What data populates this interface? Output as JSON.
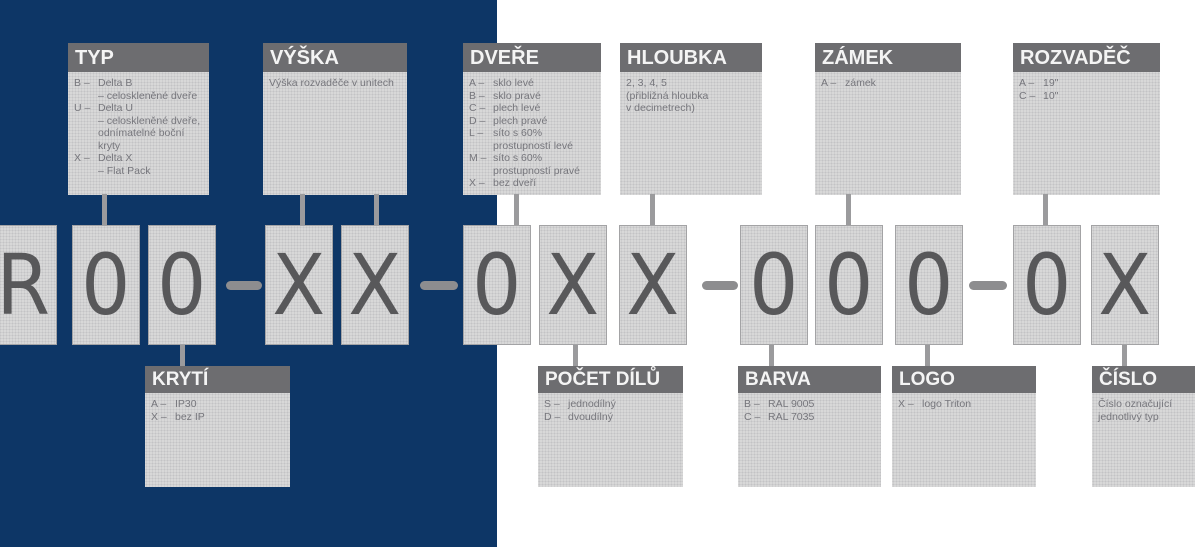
{
  "diagram_title": "Schéma značení rozvaděče",
  "colors": {
    "background_left": "#0d3666",
    "background_right": "#ffffff",
    "label_header": "#6d6d70",
    "label_fill": "#d9d9d9",
    "header_text": "#f4f4f4",
    "body_text": "#76767c",
    "code_char": "#58585a",
    "connector": "#9b9b9d"
  },
  "code": {
    "display": "R00–XX–0XX–000–0X",
    "chars": [
      "R",
      "0",
      "0",
      "X",
      "X",
      "0",
      "X",
      "X",
      "0",
      "0",
      "0",
      "0",
      "X"
    ]
  },
  "top_labels": [
    {
      "title": "TYP",
      "lines": [
        {
          "k": "B –",
          "t": "Delta B"
        },
        {
          "k": "",
          "t": "– celoskleněné dveře"
        },
        {
          "k": "U –",
          "t": "Delta U"
        },
        {
          "k": "",
          "t": "– celoskleněné dveře,"
        },
        {
          "k": "",
          "t": "odnímatelné boční"
        },
        {
          "k": "",
          "t": "kryty"
        },
        {
          "k": "X –",
          "t": "Delta X"
        },
        {
          "k": "",
          "t": "– Flat Pack"
        }
      ]
    },
    {
      "title": "VÝŠKA",
      "lines": [
        {
          "t": "Výška rozvaděče v unitech"
        }
      ]
    },
    {
      "title": "DVEŘE",
      "lines": [
        {
          "k": "A –",
          "t": "sklo levé"
        },
        {
          "k": "B –",
          "t": "sklo pravé"
        },
        {
          "k": "C –",
          "t": "plech levé"
        },
        {
          "k": "D –",
          "t": "plech pravé"
        },
        {
          "k": "L –",
          "t": "síto s 60%"
        },
        {
          "k": "",
          "t": "prostupností levé"
        },
        {
          "k": "M –",
          "t": "síto s 60%"
        },
        {
          "k": "",
          "t": "prostupností pravé"
        },
        {
          "k": "X –",
          "t": "bez dveří"
        }
      ]
    },
    {
      "title": "HLOUBKA",
      "lines": [
        {
          "t": "2, 3, 4, 5"
        },
        {
          "t": "(přibližná hloubka"
        },
        {
          "t": "v decimetrech)"
        }
      ]
    },
    {
      "title": "ZÁMEK",
      "lines": [
        {
          "k": "A –",
          "t": "zámek"
        }
      ]
    },
    {
      "title": "ROZVADĚČ",
      "lines": [
        {
          "k": "A –",
          "t": "19\""
        },
        {
          "k": "C –",
          "t": "10\""
        }
      ]
    }
  ],
  "bottom_labels": [
    {
      "title": "KRYTÍ",
      "lines": [
        {
          "k": "A –",
          "t": "IP30"
        },
        {
          "k": "X –",
          "t": "bez IP"
        }
      ]
    },
    {
      "title": "POČET DÍLŮ",
      "lines": [
        {
          "k": "S –",
          "t": "jednodílný"
        },
        {
          "k": "D –",
          "t": "dvoudílný"
        }
      ]
    },
    {
      "title": "BARVA",
      "lines": [
        {
          "k": "B –",
          "t": "RAL 9005"
        },
        {
          "k": "C –",
          "t": "RAL 7035"
        }
      ]
    },
    {
      "title": "LOGO",
      "lines": [
        {
          "k": "X –",
          "t": "logo Triton"
        }
      ]
    },
    {
      "title": "ČÍSLO",
      "lines": [
        {
          "t": "Číslo označující"
        },
        {
          "t": "jednotlivý typ"
        }
      ]
    }
  ]
}
